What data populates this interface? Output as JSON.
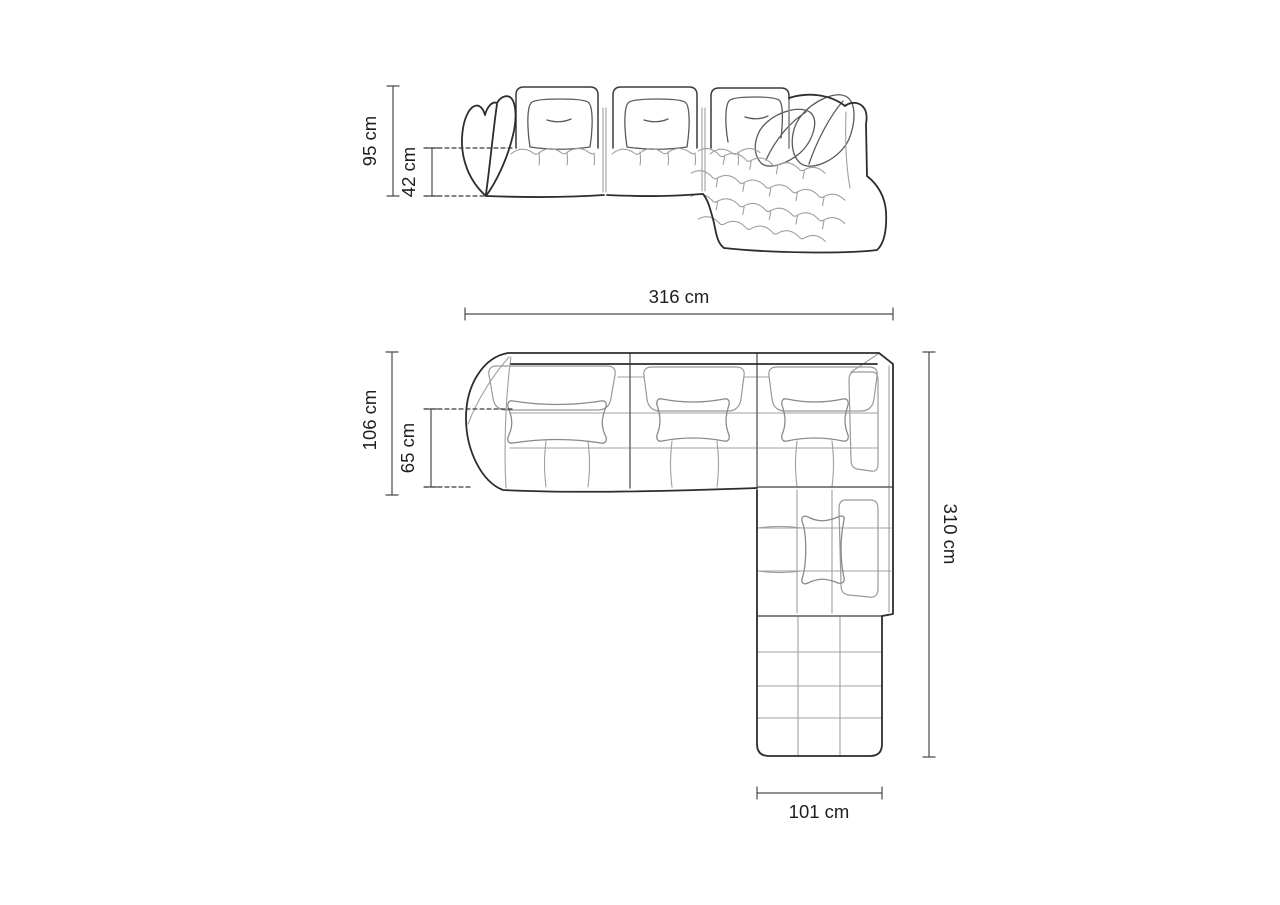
{
  "diagram": {
    "kind": "corner-sofa-dimension-drawing",
    "background": "#ffffff",
    "colors": {
      "outline": "#2d2d2d",
      "mid_line": "#5f5f5f",
      "light_line": "#a0a0a0",
      "dimension_line": "#4a4a4a",
      "label_text": "#1e1e1e"
    },
    "views": {
      "front": {
        "dimensions": {
          "overall_height": "95 cm",
          "seat_height": "42 cm"
        }
      },
      "top": {
        "dimensions": {
          "overall_width": "316 cm",
          "overall_depth": "106 cm",
          "seat_depth": "65 cm",
          "overall_length": "310 cm",
          "chaise_width": "101 cm"
        }
      }
    }
  }
}
